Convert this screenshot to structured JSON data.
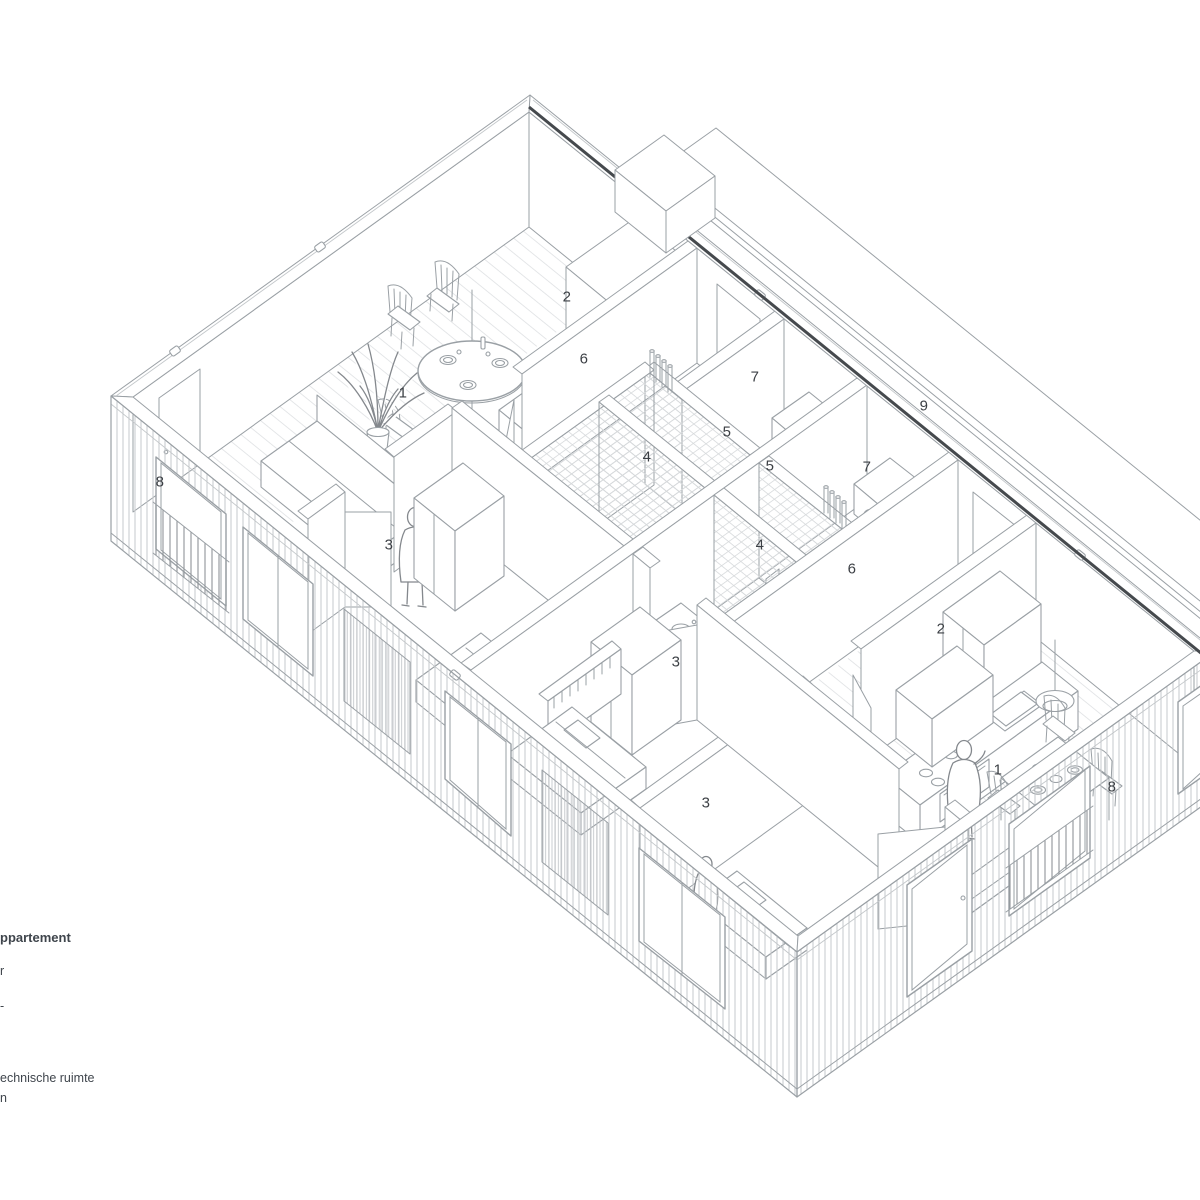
{
  "drawing_title": "axonometric apartment floor-plan cutaway",
  "colors": {
    "background": "#ffffff",
    "line": "#9aa0a5",
    "line_dark": "#45494d",
    "hatch": "#c6c9cc",
    "text": "#3c4045"
  },
  "legend": {
    "title_fragment": "ppartement",
    "item1_fragment": "r",
    "item2_fragment": "-",
    "item3_fragment": "echnische ruimte",
    "item4_fragment": "n"
  },
  "plan_labels": [
    {
      "n": "1",
      "x": 403,
      "y": 393
    },
    {
      "n": "2",
      "x": 567,
      "y": 297
    },
    {
      "n": "6",
      "x": 584,
      "y": 359
    },
    {
      "n": "7",
      "x": 755,
      "y": 377
    },
    {
      "n": "5",
      "x": 727,
      "y": 432
    },
    {
      "n": "4",
      "x": 647,
      "y": 457
    },
    {
      "n": "5",
      "x": 770,
      "y": 466
    },
    {
      "n": "7",
      "x": 867,
      "y": 467
    },
    {
      "n": "9",
      "x": 924,
      "y": 406
    },
    {
      "n": "4",
      "x": 760,
      "y": 545
    },
    {
      "n": "6",
      "x": 852,
      "y": 569
    },
    {
      "n": "2",
      "x": 941,
      "y": 629
    },
    {
      "n": "3",
      "x": 389,
      "y": 545
    },
    {
      "n": "3",
      "x": 676,
      "y": 662
    },
    {
      "n": "3",
      "x": 706,
      "y": 803
    },
    {
      "n": "1",
      "x": 998,
      "y": 770
    },
    {
      "n": "8",
      "x": 160,
      "y": 482
    },
    {
      "n": "8",
      "x": 1112,
      "y": 787
    }
  ]
}
